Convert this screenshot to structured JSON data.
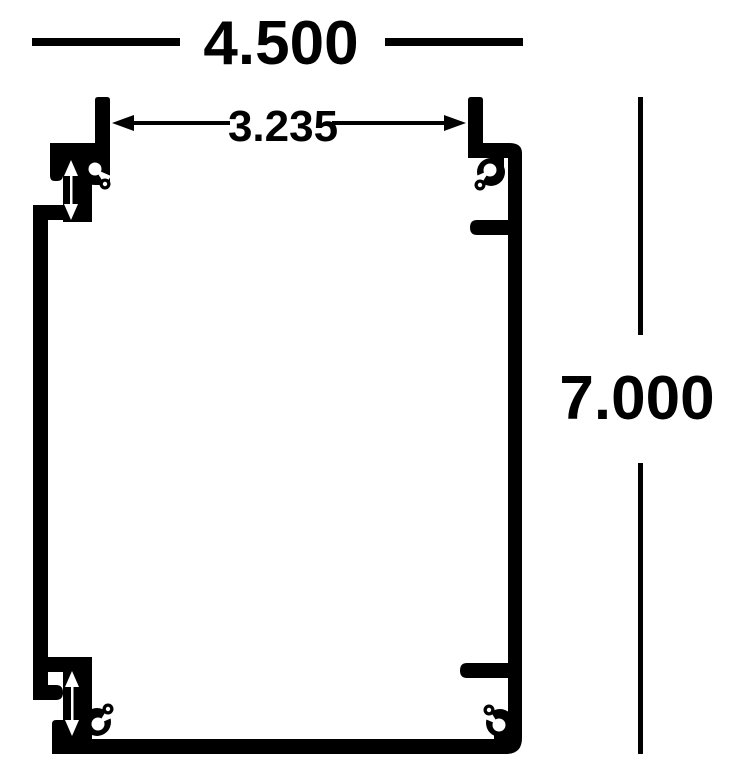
{
  "figure": {
    "colors": {
      "ink": "#000000",
      "background": "#ffffff"
    },
    "dimensions": {
      "overall_width": {
        "value": "4.500"
      },
      "inner_tab_spacing": {
        "value": "3.235"
      },
      "overall_height": {
        "value": "7.000"
      }
    }
  }
}
